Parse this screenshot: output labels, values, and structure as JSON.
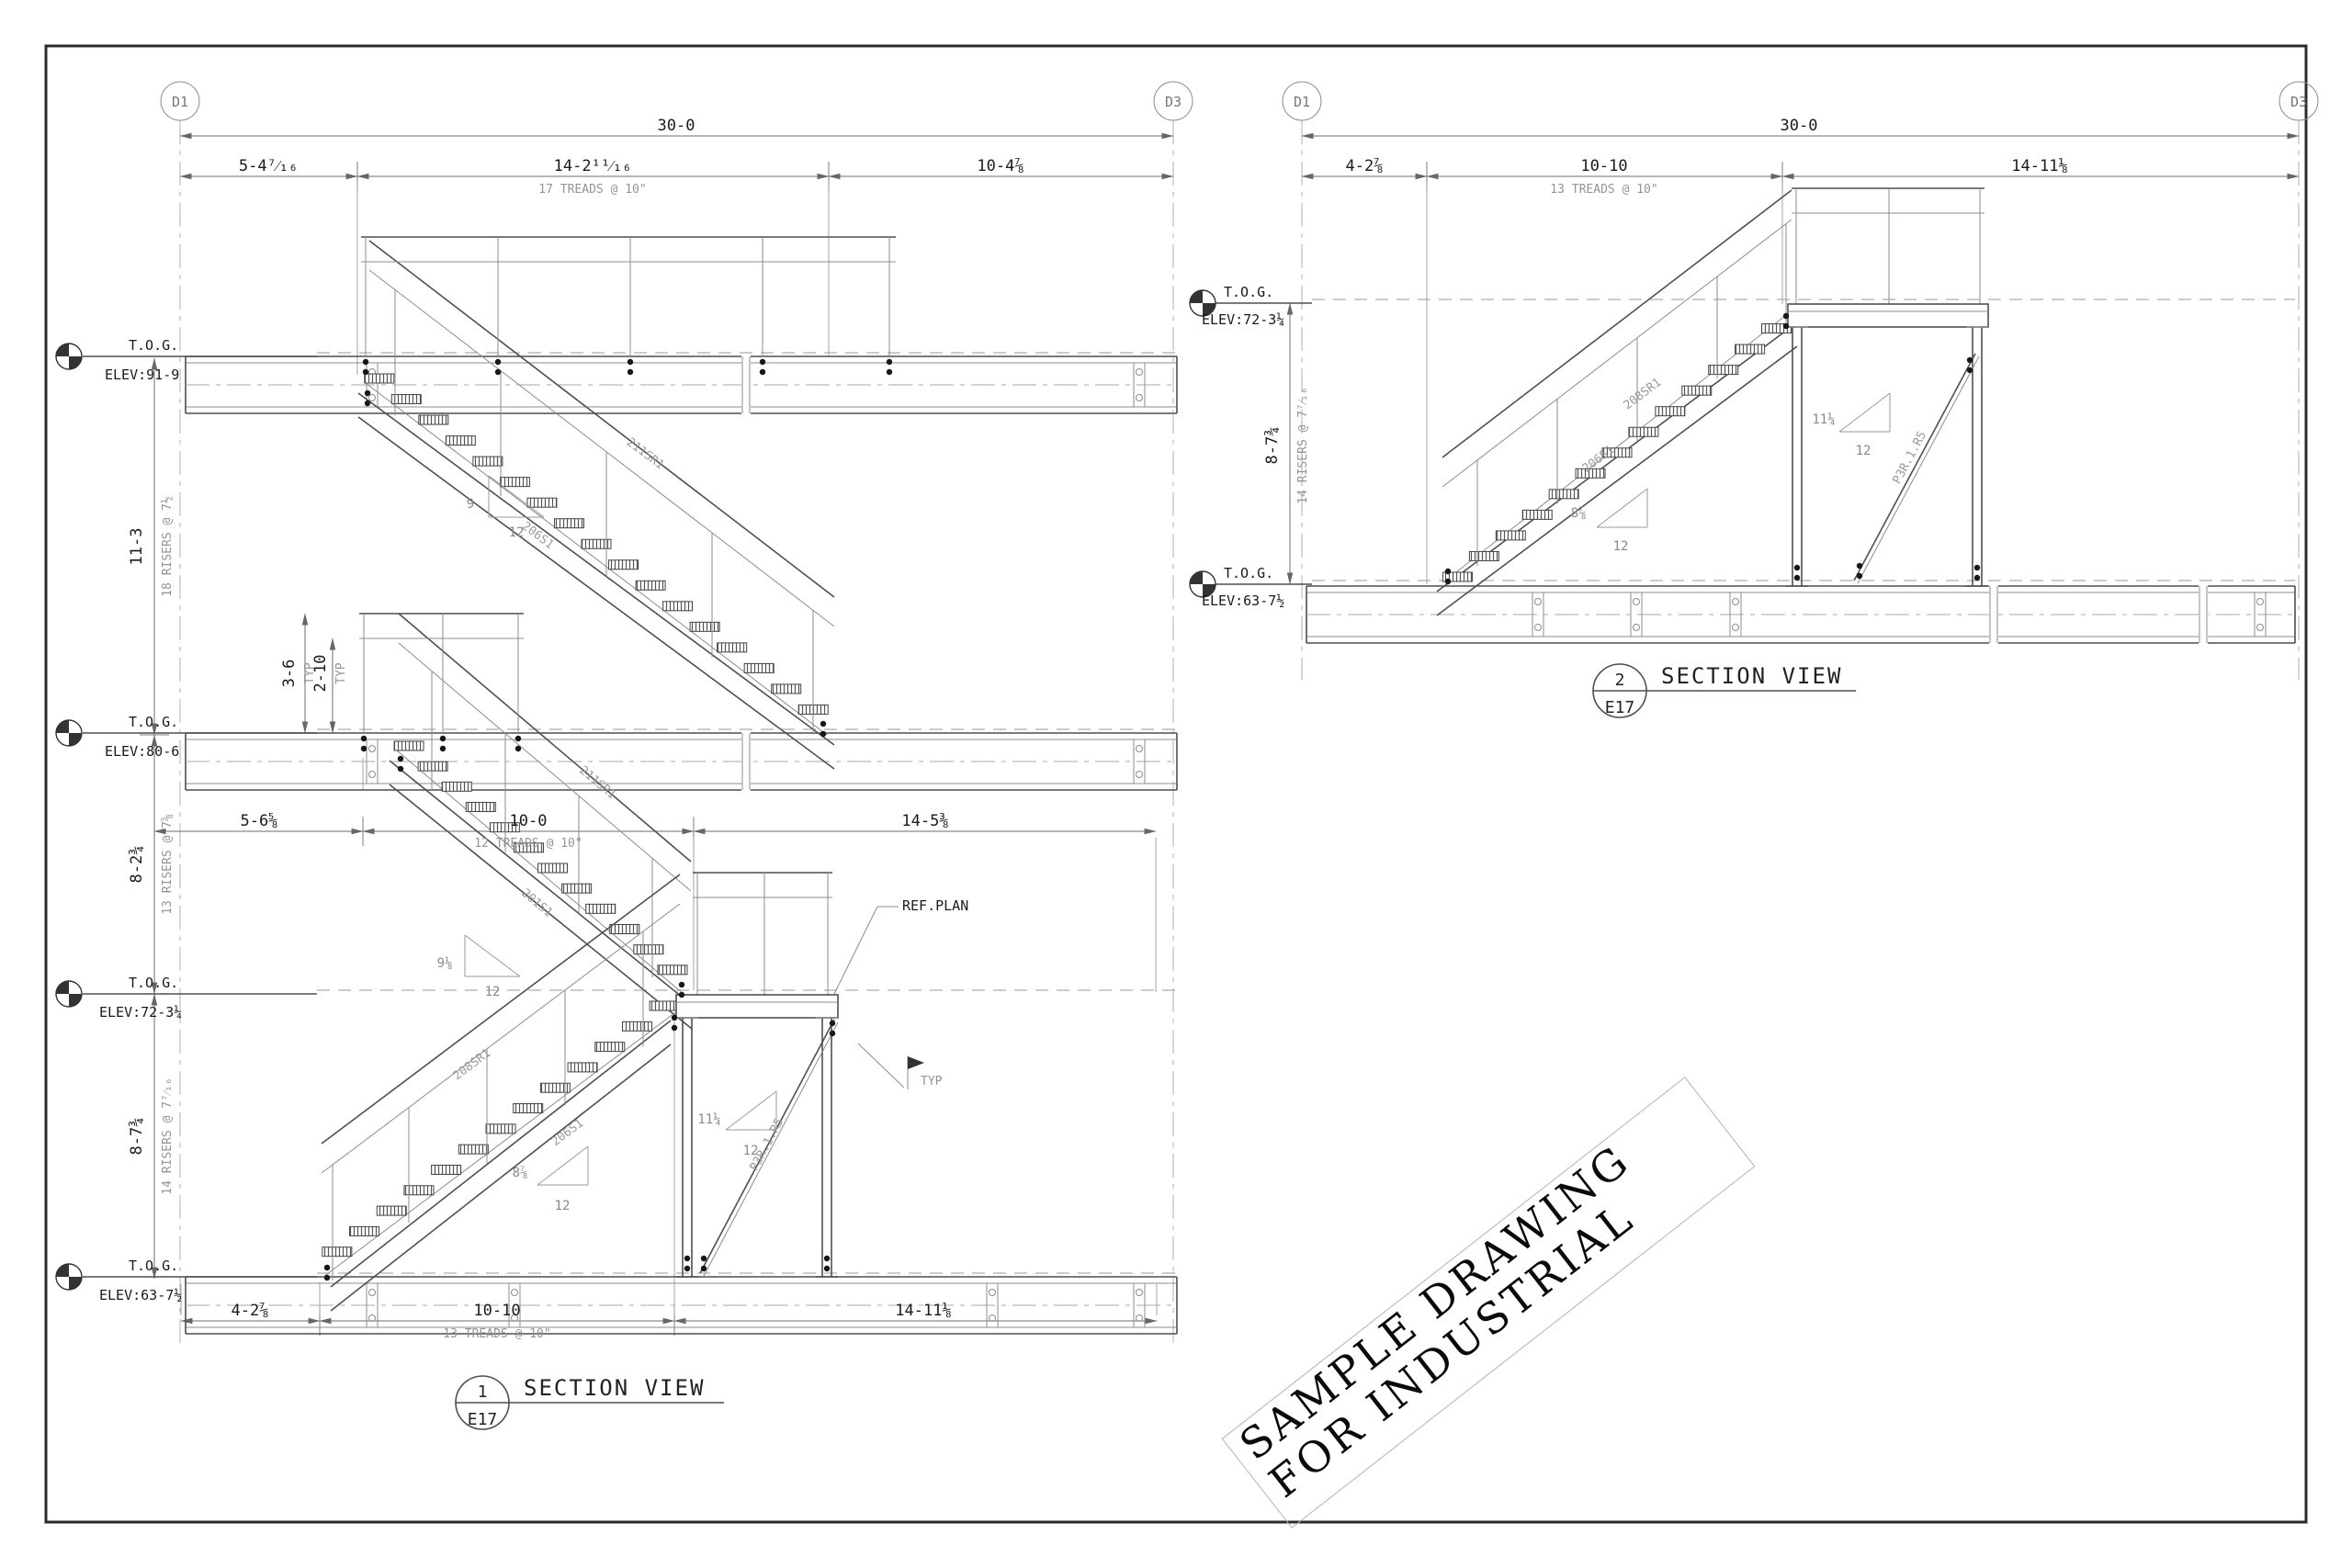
{
  "colors": {
    "sheet_border": "#2b2b2b",
    "main_line": "#4f4f4f",
    "dim_line": "#6e6e6e",
    "note_text": "#949494",
    "dark_text": "#1a1a1a"
  },
  "views": [
    {
      "bubbles": [
        "D1",
        "D3"
      ],
      "dim_overall": "30-0",
      "top_dims": [
        {
          "v": "5-4⁷⁄₁₆"
        },
        {
          "v": "14-2¹¹⁄₁₆",
          "note": "17 TREADS @ 10\""
        },
        {
          "v": "10-4⅞"
        }
      ],
      "mid_dims": [
        {
          "v": "5-6⅝"
        },
        {
          "v": "10-0",
          "note": "12 TREADS @ 10\""
        },
        {
          "v": "14-5⅜"
        }
      ],
      "bottom_dims": [
        {
          "v": "4-2⅞"
        },
        {
          "v": "10-10",
          "note": "13 TREADS @ 10\""
        },
        {
          "v": "14-11⅛"
        }
      ],
      "vert_dims": [
        {
          "v": "11-3",
          "note": "18 RISERS @ 7½"
        },
        {
          "v": "8-2¾",
          "note": "13 RISERS @ 7⅝"
        },
        {
          "v": "8-7¾",
          "note": "14 RISERS @ 7⁷⁄₁₆"
        }
      ],
      "rail_dims": [
        {
          "v": "3-6",
          "note": "TYP"
        },
        {
          "v": "2-10",
          "note": "TYP"
        }
      ],
      "elevations": [
        {
          "t": "T.O.G.",
          "e": "ELEV:91-9"
        },
        {
          "t": "T.O.G.",
          "e": "ELEV:80-6"
        },
        {
          "t": "T.O.G.",
          "e": "ELEV:72-3¼"
        },
        {
          "t": "T.O.G.",
          "e": "ELEV:63-7½"
        }
      ],
      "slopes": [
        {
          "rise": "9",
          "run": "12"
        },
        {
          "rise": "9⅛",
          "run": "12"
        },
        {
          "rise": "8⅞",
          "run": "12"
        },
        {
          "rise": "11¼",
          "run": "12"
        }
      ],
      "members": [
        "211SR1",
        "206S1",
        "211SR1",
        "201S1",
        "208SR1",
        "206S1"
      ],
      "brace_label": "P3R.1.R5",
      "callout_ref": "REF.PLAN",
      "callout_typ": "TYP",
      "title": {
        "num": "1",
        "sheet": "E17",
        "label": "SECTION VIEW"
      }
    },
    {
      "bubbles": [
        "D1",
        "D3"
      ],
      "dim_overall": "30-0",
      "top_dims": [
        {
          "v": "4-2⅞"
        },
        {
          "v": "10-10",
          "note": "13 TREADS @ 10\""
        },
        {
          "v": "14-11⅛"
        }
      ],
      "vert_dims": [
        {
          "v": "8-7¾",
          "note": "14 RISERS @ 7⁷⁄₁₆"
        }
      ],
      "elevations": [
        {
          "t": "T.O.G.",
          "e": "ELEV:72-3¼"
        },
        {
          "t": "T.O.G.",
          "e": "ELEV:63-7½"
        }
      ],
      "slopes": [
        {
          "rise": "8⅞",
          "run": "12"
        },
        {
          "rise": "11¼",
          "run": "12"
        }
      ],
      "members": [
        "208SR1",
        "206S1"
      ],
      "brace_label": "P3R.1.R5",
      "title": {
        "num": "2",
        "sheet": "E17",
        "label": "SECTION VIEW"
      }
    }
  ],
  "watermark": {
    "line1": "SAMPLE DRAWING",
    "line2": "FOR INDUSTRIAL"
  }
}
